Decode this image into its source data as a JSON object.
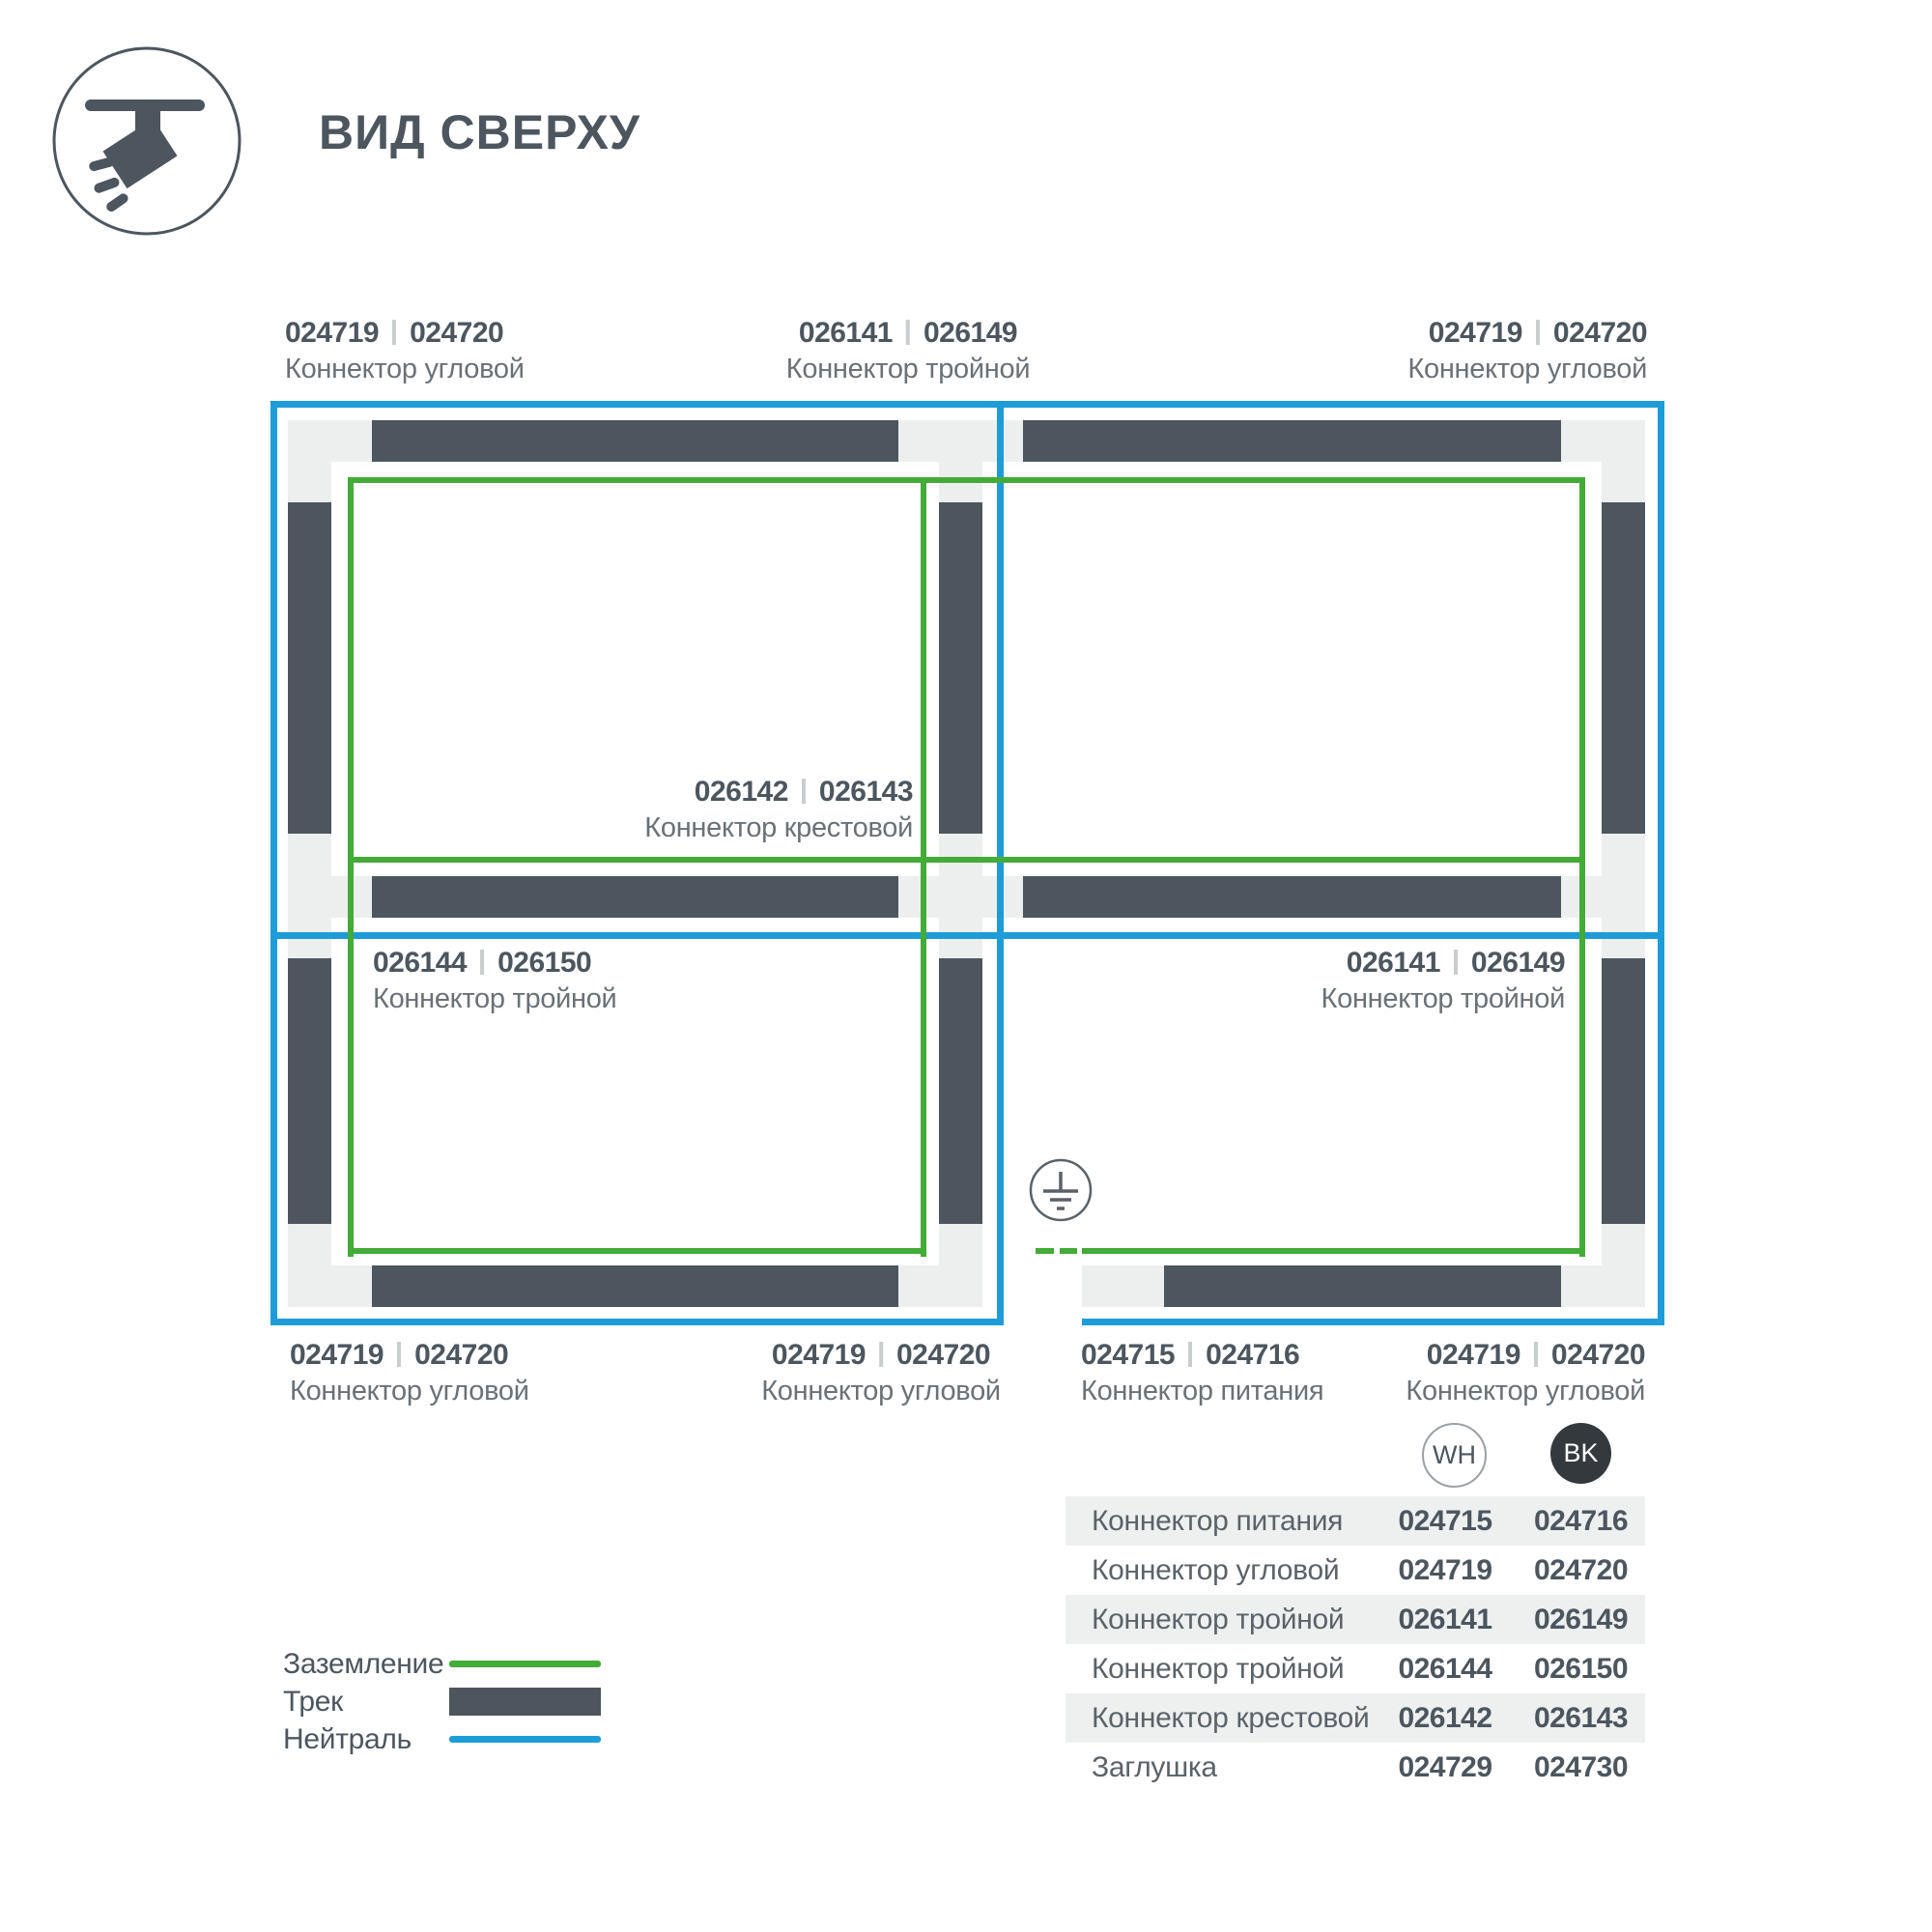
{
  "title": "ВИД СВЕРХУ",
  "icons": {
    "header": "track-spotlight-icon",
    "diagram": "earth-ground-icon"
  },
  "colors": {
    "track": "#4d565e",
    "track_base": "#edefef",
    "ground_line": "#43ab37",
    "neutral_line": "#1e9cd8",
    "text_primary": "#4d565e",
    "text_secondary": "#6a7177",
    "table_row_alt": "#eef0f0",
    "bk_circle": "#34393d"
  },
  "connector_labels": {
    "top_left": {
      "wh": "024719",
      "bk": "024720",
      "name": "Коннектор угловой"
    },
    "top_middle": {
      "wh": "026141",
      "bk": "026149",
      "name": "Коннектор тройной"
    },
    "top_right": {
      "wh": "024719",
      "bk": "024720",
      "name": "Коннектор угловой"
    },
    "center_cross": {
      "wh": "026142",
      "bk": "026143",
      "name": "Коннектор крестовой"
    },
    "mid_left": {
      "wh": "026144",
      "bk": "026150",
      "name": "Коннектор тройной"
    },
    "mid_right": {
      "wh": "026141",
      "bk": "026149",
      "name": "Коннектор тройной"
    },
    "bottom_left": {
      "wh": "024719",
      "bk": "024720",
      "name": "Коннектор угловой"
    },
    "bottom_middle": {
      "wh": "024719",
      "bk": "024720",
      "name": "Коннектор угловой"
    },
    "bottom_power": {
      "wh": "024715",
      "bk": "024716",
      "name": "Коннектор питания"
    },
    "bottom_right": {
      "wh": "024719",
      "bk": "024720",
      "name": "Коннектор угловой"
    }
  },
  "legend": {
    "items": [
      {
        "label": "Заземление",
        "swatch": "ground-line"
      },
      {
        "label": "Трек",
        "swatch": "track-bar"
      },
      {
        "label": "Нейтраль",
        "swatch": "neutral-line"
      }
    ]
  },
  "table": {
    "col_headers": [
      "WH",
      "BK"
    ],
    "rows": [
      {
        "name": "Коннектор питания",
        "wh": "024715",
        "bk": "024716"
      },
      {
        "name": "Коннектор угловой",
        "wh": "024719",
        "bk": "024720"
      },
      {
        "name": "Коннектор тройной",
        "wh": "026141",
        "bk": "026149"
      },
      {
        "name": "Коннектор тройной",
        "wh": "026144",
        "bk": "026150"
      },
      {
        "name": "Коннектор крестовой",
        "wh": "026142",
        "bk": "026143"
      },
      {
        "name": "Заглушка",
        "wh": "024729",
        "bk": "024730"
      }
    ]
  }
}
